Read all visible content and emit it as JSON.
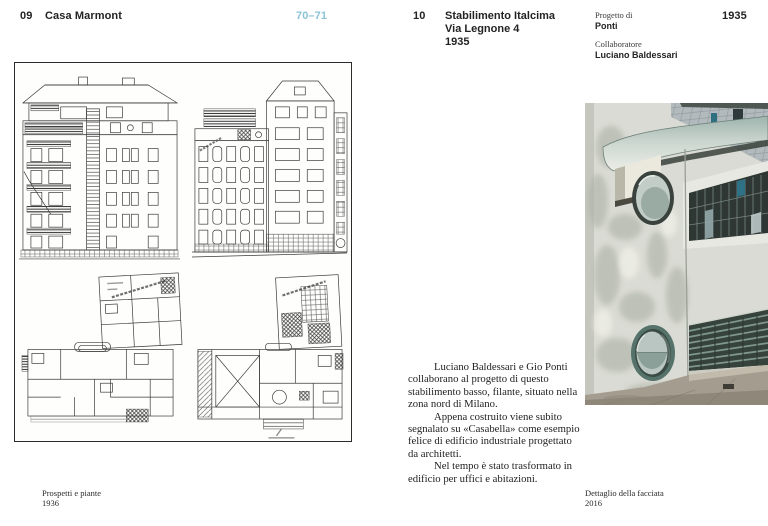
{
  "left_page": {
    "index": "09",
    "title": "Casa Marmont",
    "folio": "70–71",
    "caption": [
      "Prospetti e piante",
      "1936"
    ]
  },
  "right_page": {
    "index": "10",
    "title_lines": [
      "Stabilimento Italcima",
      "Via Legnone 4",
      "1935"
    ],
    "year": "1935",
    "credits": [
      {
        "label": "Progetto di",
        "name": "Ponti"
      },
      {
        "label": "Collaboratore",
        "name": "Luciano Baldessari"
      }
    ],
    "body_paragraphs": [
      "Luciano Baldessari e Gio Ponti collaborano al progetto di questo stabilimento basso, filante, situato nella zona nord di Milano.",
      "Appena costruito viene subito segnalato su «Casabella» come esempio felice di edificio industriale progettato da architetti.",
      "Nel tempo è stato trasformato in edificio per uffici e abitazioni."
    ],
    "caption": [
      "Dettaglio della facciata",
      "2016"
    ]
  },
  "figures": {
    "left_figure": "architectural elevations and floor plans of Casa Marmont",
    "right_figure": "photograph of Italcima factory facade detail"
  },
  "colors": {
    "folio_accent": "#8ac4d6",
    "text_primary": "#232323",
    "canopy_teal": "#9db4ad",
    "porthole_ring": "#55736a",
    "louver_green": "#7f978b"
  }
}
